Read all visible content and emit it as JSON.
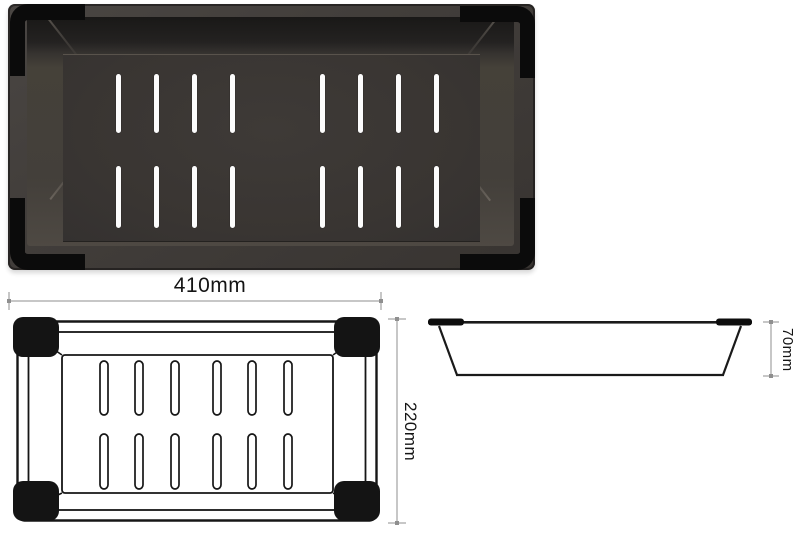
{
  "title": "Colander insert product views",
  "photo": {
    "name": "black colander insert top photo",
    "body_color": "#3f3b38",
    "bumper_color": "#0b0b0b",
    "slot_color": "#ffffff",
    "slot_count": 16
  },
  "top_view": {
    "width_dim": "410mm",
    "height_dim": "220mm",
    "slot_count": 12
  },
  "side_view": {
    "depth_dim": "70mm"
  },
  "style": {
    "line_color": "#1a1a1a",
    "dim_line_color": "#c7c7c7",
    "dim_tick_color": "#8f8f8f",
    "label_color": "#141414",
    "background": "#ffffff"
  }
}
